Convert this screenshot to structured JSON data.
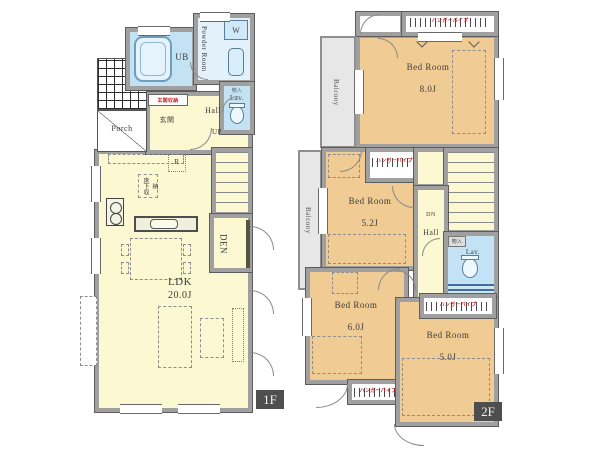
{
  "f1": {
    "badge": "1F",
    "porch": "Porch",
    "ub": "UB",
    "powder_room": "Powder Room",
    "washer": "W",
    "lav": "Lav.",
    "lav_note": "物入",
    "entry_storage": "玄関収納",
    "entry": "玄関",
    "hall": "Hall",
    "up": "UP",
    "fridge": "R",
    "floor_storage": "床下収納",
    "ldk_name": "LDK",
    "ldk_size": "20.0J",
    "den": "DEN"
  },
  "f2": {
    "badge": "2F",
    "balcony": "Balcony",
    "closet_label": "ハンガーパイプ",
    "hall": "Hall",
    "dn": "DN",
    "lav": "Lav.",
    "lav_note": "物入",
    "bedrooms": [
      {
        "name": "Bed Room",
        "size": "8.0J"
      },
      {
        "name": "Bed Room",
        "size": "5.2J"
      },
      {
        "name": "Bed Room",
        "size": "6.0J"
      },
      {
        "name": "Bed Room",
        "size": "5.0J"
      }
    ]
  },
  "colors": {
    "room_1f": "#fbf8d2",
    "room_2f": "#f0cb93",
    "wet_room": "#c3e3f5",
    "balcony": "#e7e7e7",
    "wall": "#a0a0a0",
    "storage_label_red": "#c3272b",
    "badge_bg": "#4e4e4e"
  }
}
